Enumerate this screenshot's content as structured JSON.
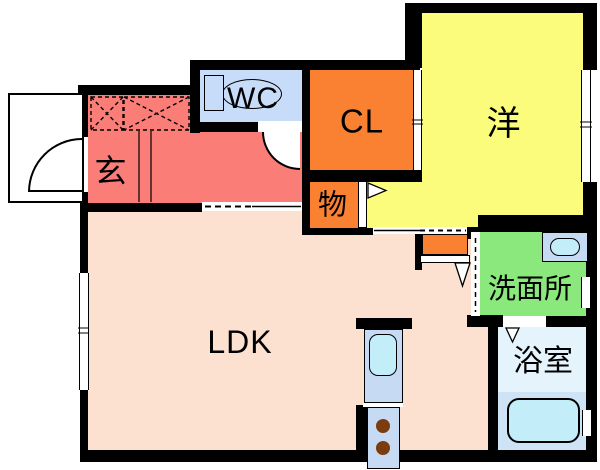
{
  "title": "1LDK apartment floor plan",
  "rooms": {
    "genkan": {
      "label": "玄",
      "color": "#fa7d78"
    },
    "wc": {
      "label": "WC",
      "color": "#c7dcf8"
    },
    "closet": {
      "label": "CL",
      "color": "#fa8132"
    },
    "western": {
      "label": "洋",
      "color": "#fcfc7c"
    },
    "storage": {
      "label": "物",
      "color": "#fa8132"
    },
    "ldk": {
      "label": "LDK",
      "color": "#fce0d0"
    },
    "washroom": {
      "label": "洗面所",
      "color": "#8ae87c"
    },
    "bathroom": {
      "label": "浴室",
      "color": "#e4f3fc"
    }
  },
  "palette": {
    "wall": "#000000",
    "background": "#ffffff",
    "bathroom_lower": "#cfe3f7",
    "fixture_unit_blue": "#c6daf4",
    "water_cyan": "#c2edf9",
    "burner_brown": "#7b3c0f"
  },
  "fixtures": [
    "toilet",
    "washbasin",
    "bathtub",
    "kitchen-sink",
    "two-burner-stove",
    "shoe-cabinet",
    "entry-door",
    "wc-door",
    "sliding-doors",
    "windows"
  ]
}
